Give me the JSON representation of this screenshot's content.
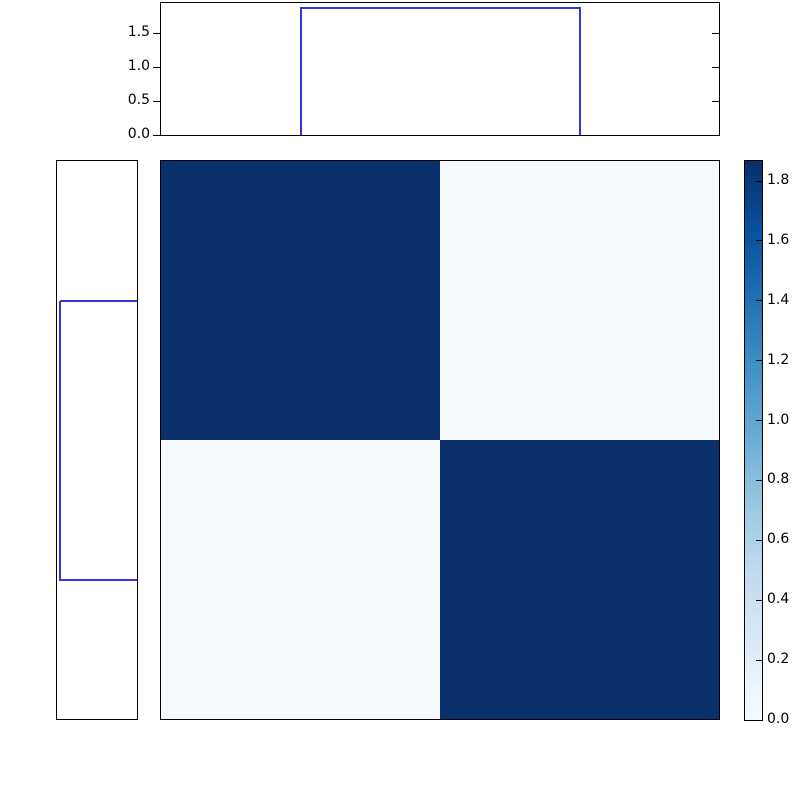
{
  "figure": {
    "kind": "clustered-heatmap-with-dendrograms",
    "background": "#ffffff",
    "spine_color": "#000000",
    "tick_color": "#000000",
    "dendrogram_line_color": "#3434dd",
    "colormap": "Blues"
  },
  "chart_data": [
    {
      "type": "line",
      "role": "dendrogram-top",
      "orientation": "top",
      "description": "Hierarchical clustering dendrogram: single link joining two leaves",
      "leaf_position_fractions": [
        0.25,
        0.75
      ],
      "merge_height": 1.87,
      "ylim": [
        0,
        1.95
      ],
      "yticks": [
        0.0,
        0.5,
        1.0,
        1.5
      ],
      "ytick_labels": [
        "0.0",
        "0.5",
        "1.0",
        "1.5"
      ],
      "line_color": "#3434dd"
    },
    {
      "type": "line",
      "role": "dendrogram-left",
      "orientation": "left",
      "description": "Hierarchical clustering dendrogram: single link joining two leaves, distance increasing leftward",
      "leaf_position_fractions": [
        0.25,
        0.75
      ],
      "merge_height": 1.87,
      "xlim": [
        1.95,
        0
      ],
      "line_color": "#3434dd"
    },
    {
      "type": "heatmap",
      "role": "matrix",
      "rows": 2,
      "cols": 2,
      "matrix": [
        [
          1.85,
          0.06
        ],
        [
          0.06,
          1.85
        ]
      ],
      "vmin": 0.0,
      "vmax": 1.867,
      "colormap": "Blues",
      "cell_colors": [
        [
          "#0a316e",
          "#f6f9fe"
        ],
        [
          "#f6f9fe",
          "#0a316e"
        ]
      ],
      "grid": false
    },
    {
      "type": "colorbar",
      "role": "colorbar",
      "orientation": "vertical",
      "vmin": 0.0,
      "vmax": 1.867,
      "ticks": [
        1.8,
        1.6,
        1.4,
        1.2,
        1.0,
        0.8,
        0.6,
        0.4,
        0.2,
        0.0
      ],
      "tick_labels": [
        "1.8",
        "1.6",
        "1.4",
        "1.2",
        "1.0",
        "0.8",
        "0.6",
        "0.4",
        "0.2",
        "0.0"
      ],
      "gradient_stops": [
        {
          "frac": 0.0,
          "color": "#f7fbff"
        },
        {
          "frac": 0.125,
          "color": "#deebf7"
        },
        {
          "frac": 0.25,
          "color": "#c6dbef"
        },
        {
          "frac": 0.375,
          "color": "#9ecae1"
        },
        {
          "frac": 0.5,
          "color": "#6baed6"
        },
        {
          "frac": 0.625,
          "color": "#4292c6"
        },
        {
          "frac": 0.75,
          "color": "#2171b5"
        },
        {
          "frac": 0.875,
          "color": "#08519c"
        },
        {
          "frac": 1.0,
          "color": "#08306b"
        }
      ]
    }
  ]
}
